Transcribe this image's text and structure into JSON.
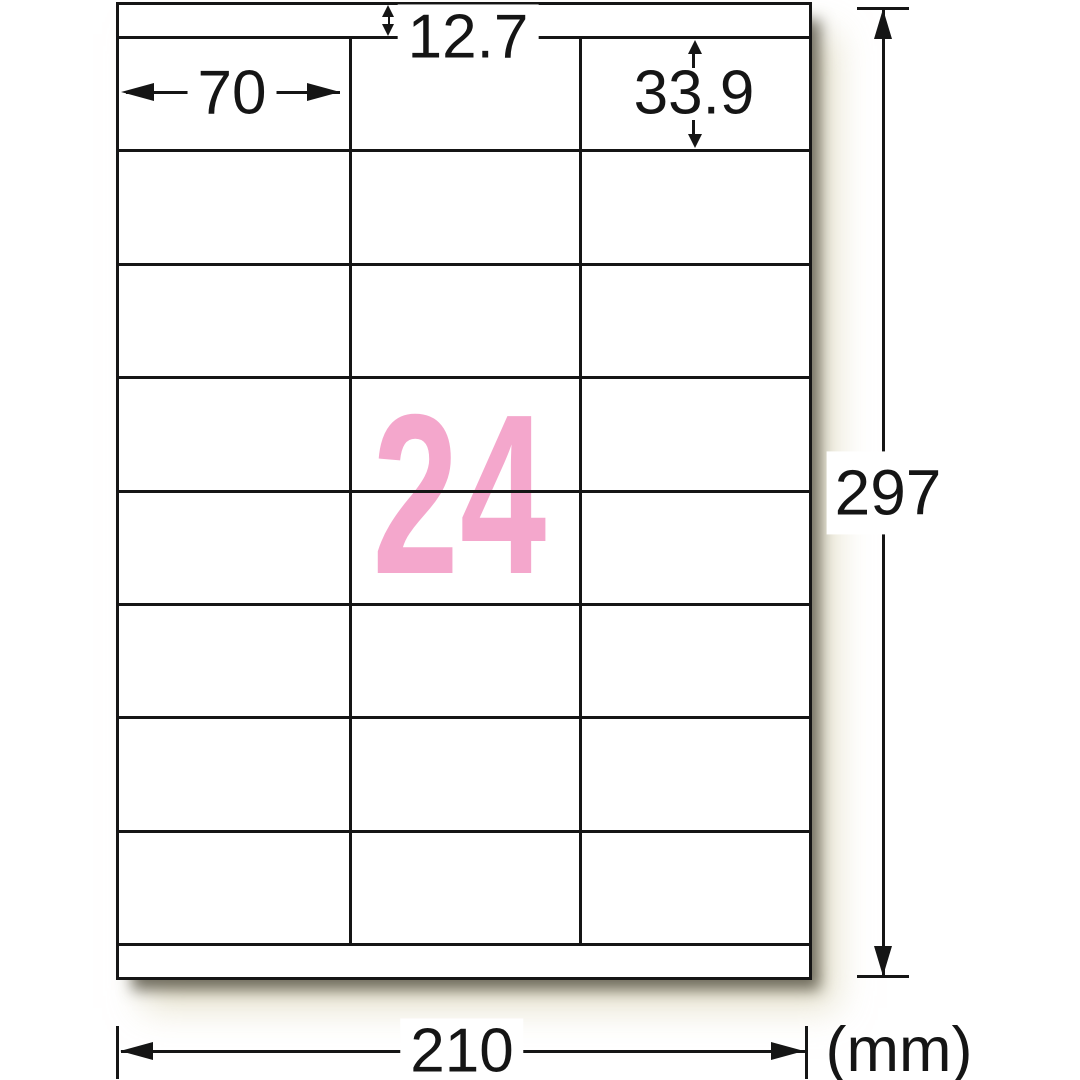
{
  "diagram": {
    "type": "label-sheet-dimension-spec",
    "sheet": {
      "label_count": "24",
      "grid": {
        "columns": 3,
        "rows": 8
      }
    },
    "dimensions": {
      "top_margin_mm": "12.7",
      "label_width_mm": "70",
      "label_height_mm": "33.9",
      "sheet_height_mm": "297",
      "sheet_width_mm": "210",
      "unit": "(mm)"
    },
    "colors": {
      "count_pink": "#f4a7cc",
      "line_black": "#151515",
      "page_white": "#ffffff"
    }
  }
}
